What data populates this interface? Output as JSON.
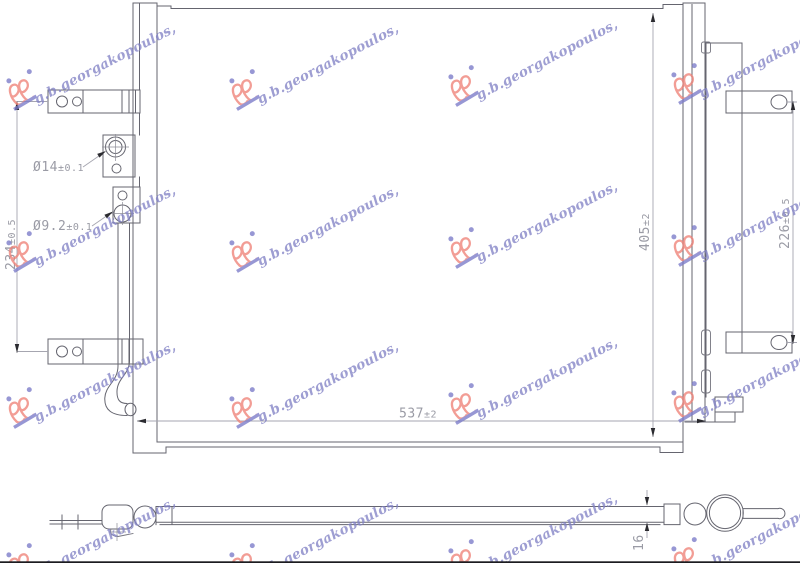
{
  "watermark": {
    "brand": "g.b.georgakopoulos,",
    "text_color": "#8282c6",
    "logo_red": "#ef8177",
    "logo_blue": "#7a7ac8"
  },
  "drawing": {
    "type": "condenser-technical-drawing",
    "line_color": "#65656f",
    "dim_color": "#9a9ba5",
    "dimensions": {
      "core_width": {
        "value": "537",
        "tol": "±2"
      },
      "core_height": {
        "value": "405",
        "tol": "±2"
      },
      "bracket_span_right": {
        "value": "226",
        "tol": "±0.5"
      },
      "bracket_span_left": {
        "value": "234",
        "tol": "±0.5"
      },
      "inlet_port": {
        "value": "Ø14",
        "tol": "±0.1"
      },
      "outlet_port": {
        "value": "Ø9.2",
        "tol": "±0.1"
      },
      "core_thickness": {
        "value": "16",
        "tol": ""
      }
    }
  }
}
